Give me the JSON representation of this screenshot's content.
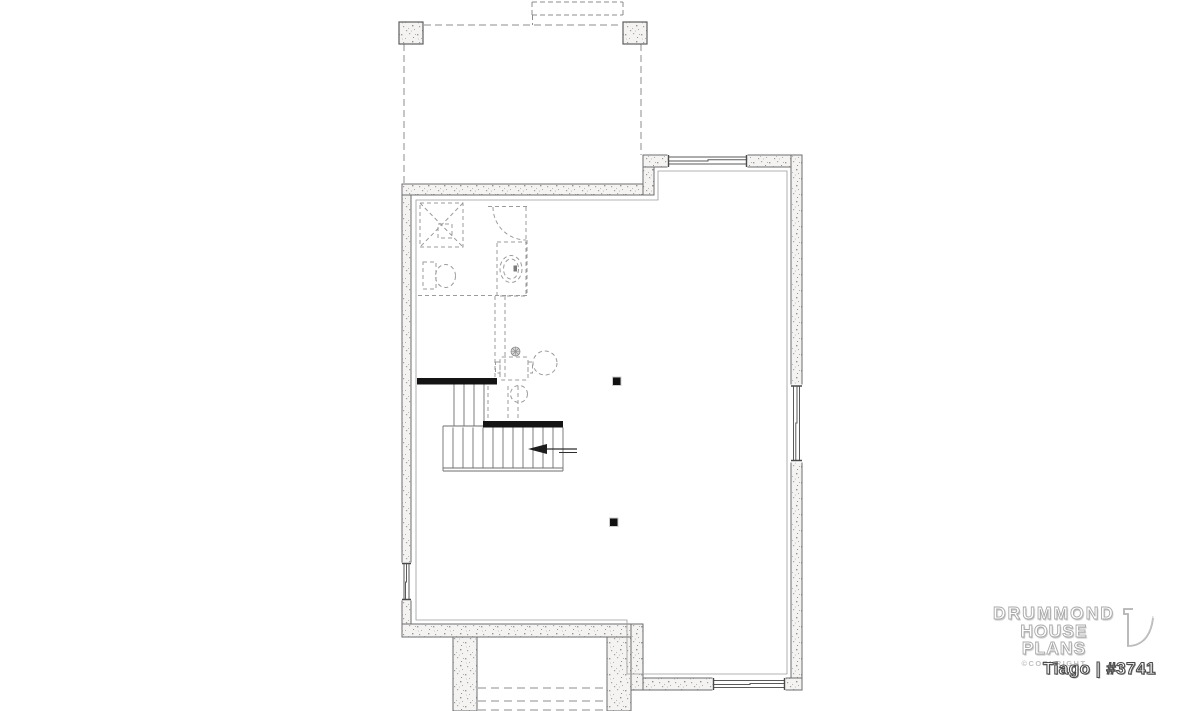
{
  "branding": {
    "line1": "DRUMMOND",
    "line2": "HOUSE PLANS",
    "copyright": "©COPYRIGHT",
    "plan_title": "Tiago | #3741"
  },
  "colors": {
    "background": "#ffffff",
    "wall_outline": "#6e6e6e",
    "wall_fill": "#f4f3f1",
    "stair_accent": "#141414",
    "dashed_lines": "#8f8f8f",
    "logo_gray": "#aeaeae"
  },
  "plan": {
    "elements": [
      "front-porch-piers",
      "porch-dashed-outline",
      "entry-steps-dashed",
      "foundation-walls",
      "footing-lines",
      "window-top",
      "window-right",
      "window-left",
      "window-bottom",
      "future-bathroom",
      "shower",
      "toilet",
      "vanity-sink",
      "bathroom-door-swing",
      "l-shaped-staircase",
      "stair-landing",
      "stair-direction-arrow",
      "water-heater",
      "laundry-tub",
      "floor-drain",
      "pump",
      "structural-posts",
      "rear-stair-well-dashed-steps"
    ]
  }
}
